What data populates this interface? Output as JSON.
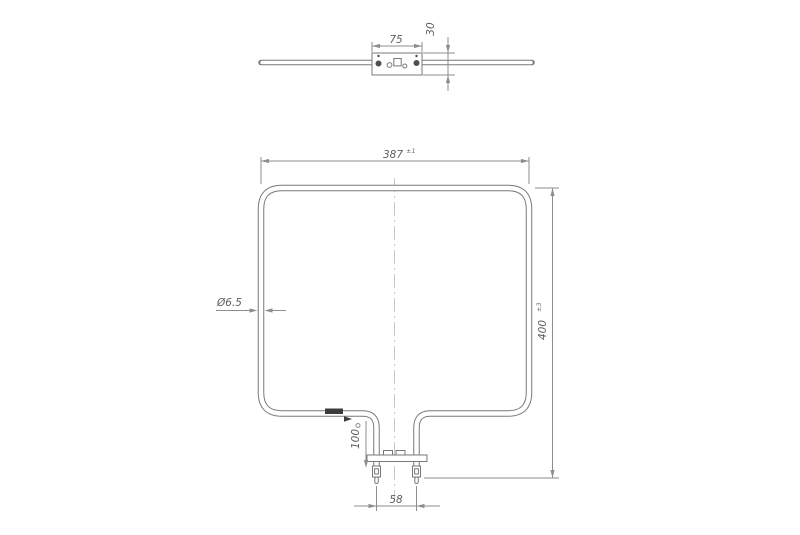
{
  "drawing": {
    "subject": "oven-heating-element-technical-drawing",
    "colors": {
      "background": "#ffffff",
      "part_line": "#787878",
      "dimension_line": "#8d8d8d",
      "text": "#5e5e5e",
      "mark": "#3c3c3c",
      "centerline": "#bcbcbc"
    },
    "top_view": {
      "bracket_width": "75",
      "bracket_height": "30"
    },
    "front_view": {
      "overall_width": "387",
      "overall_width_tol": "±1",
      "overall_height": "400",
      "overall_height_tol": "±3",
      "tube_diameter": "Ø6.5",
      "leg_length": "100",
      "terminal_pitch": "58"
    }
  }
}
